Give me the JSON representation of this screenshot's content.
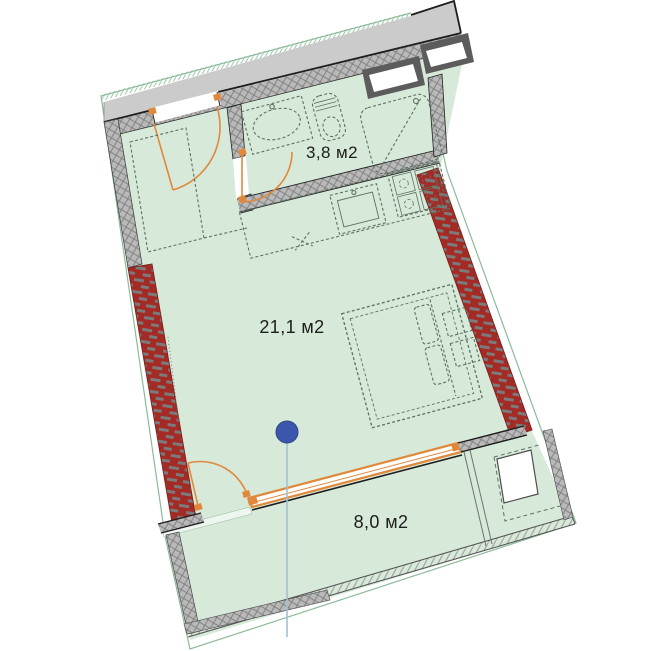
{
  "page": {
    "type": "apartment-floor-plan"
  },
  "rooms": {
    "bathroom": {
      "area_label": "3,8 м2"
    },
    "main_room": {
      "area_label": "21,1 м2"
    },
    "balcony": {
      "area_label": "8,0 м2"
    }
  },
  "marker": {
    "name": "location-pin",
    "color": "#3a57ab"
  },
  "colors": {
    "room_fill": "#d7ead9",
    "corridor_fill": "#cbcbcb",
    "wall_hatch": "#b9b9b9",
    "exterior_wall_red": "#a42a25",
    "door_orange": "#e0883c",
    "site_boundary_green": "#7fb28e",
    "pin_blue": "#3a57ab",
    "outline_black": "#1d1d1d"
  }
}
